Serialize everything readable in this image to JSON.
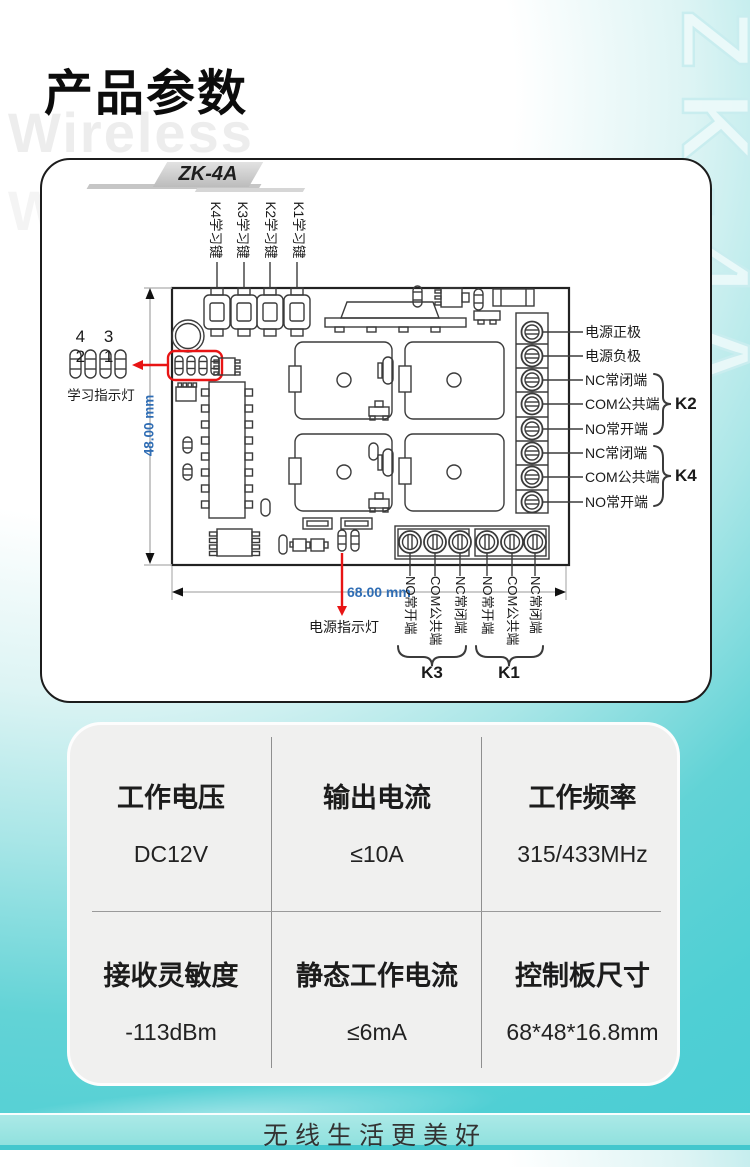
{
  "page": {
    "title": "产品参数",
    "watermark_line1": "Wireless",
    "watermark_line2": "Wireless",
    "side_watermark": "ZK-4A",
    "footer_tagline": "无线生活更美好"
  },
  "board": {
    "model_badge": "ZK-4A",
    "key_labels": [
      "K4学习键",
      "K3学习键",
      "K2学习键",
      "K1学习键"
    ],
    "led_numbers": "4 3 2 1",
    "led_label": "学习指示灯",
    "power_led_label": "电源指示灯",
    "dim_height_label": "48.00 mm",
    "dim_width_label": "68.00 mm",
    "right_terminals": [
      "电源正极",
      "电源负极",
      "NC常闭端",
      "COM公共端",
      "NO常开端",
      "NC常闭端",
      "COM公共端",
      "NO常开端"
    ],
    "right_groups": [
      "K2",
      "K4"
    ],
    "bottom_terminals": [
      "NO常开端",
      "COM公共端",
      "NC常闭端",
      "NO常开端",
      "COM公共端",
      "NC常闭端"
    ],
    "bottom_groups": [
      "K3",
      "K1"
    ]
  },
  "specs": {
    "cells": [
      {
        "label": "工作电压",
        "value": "DC12V"
      },
      {
        "label": "输出电流",
        "value": "≤10A"
      },
      {
        "label": "工作频率",
        "value": "315/433MHz"
      },
      {
        "label": "接收灵敏度",
        "value": "-113dBm"
      },
      {
        "label": "静态工作电流",
        "value": "≤6mA"
      },
      {
        "label": "控制板尺寸",
        "value": "68*48*16.8mm"
      }
    ]
  },
  "colors": {
    "accent_teal": "#4fcfd4",
    "light_teal": "#a9e6e7",
    "red_marker": "#e81414",
    "dimension_blue": "#2f6db4",
    "badge_gray": "#c6c6c6",
    "card_bg": "#f0f0ef"
  }
}
